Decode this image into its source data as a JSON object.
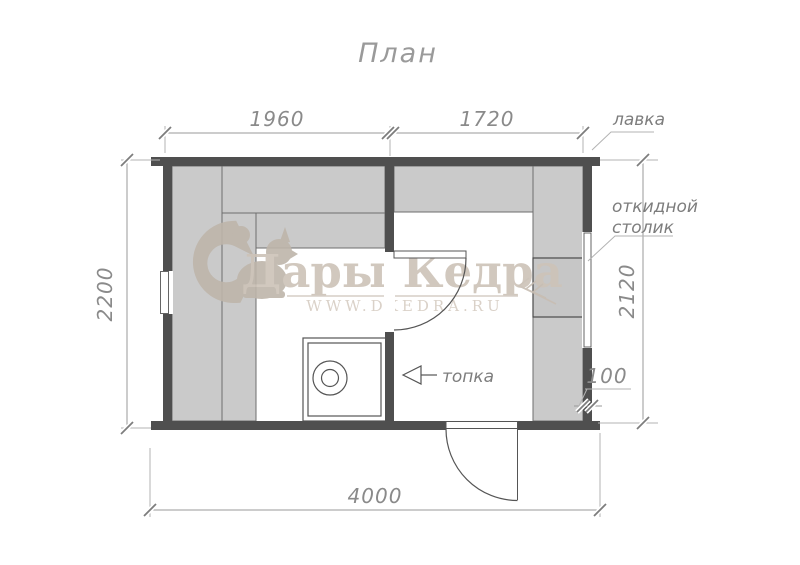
{
  "title": "План",
  "watermark": {
    "brand": "Дары Кедра",
    "site": "WWW.DKEDRA.RU"
  },
  "dimensions": {
    "top_left_room_width": "1960",
    "top_right_room_width": "1720",
    "left_outer_depth": "2200",
    "right_inner_depth": "2120",
    "total_width": "4000",
    "wall_thickness": "100"
  },
  "labels": {
    "bench": "лавка",
    "folding_table_line1": "откидной",
    "folding_table_line2": "столик",
    "firebox": "топка"
  },
  "colors": {
    "wall": "#4f4f4f",
    "bench_fill": "#cacaca",
    "watermark": "#cdc3b8",
    "dimension_line": "#9a9a9a"
  }
}
